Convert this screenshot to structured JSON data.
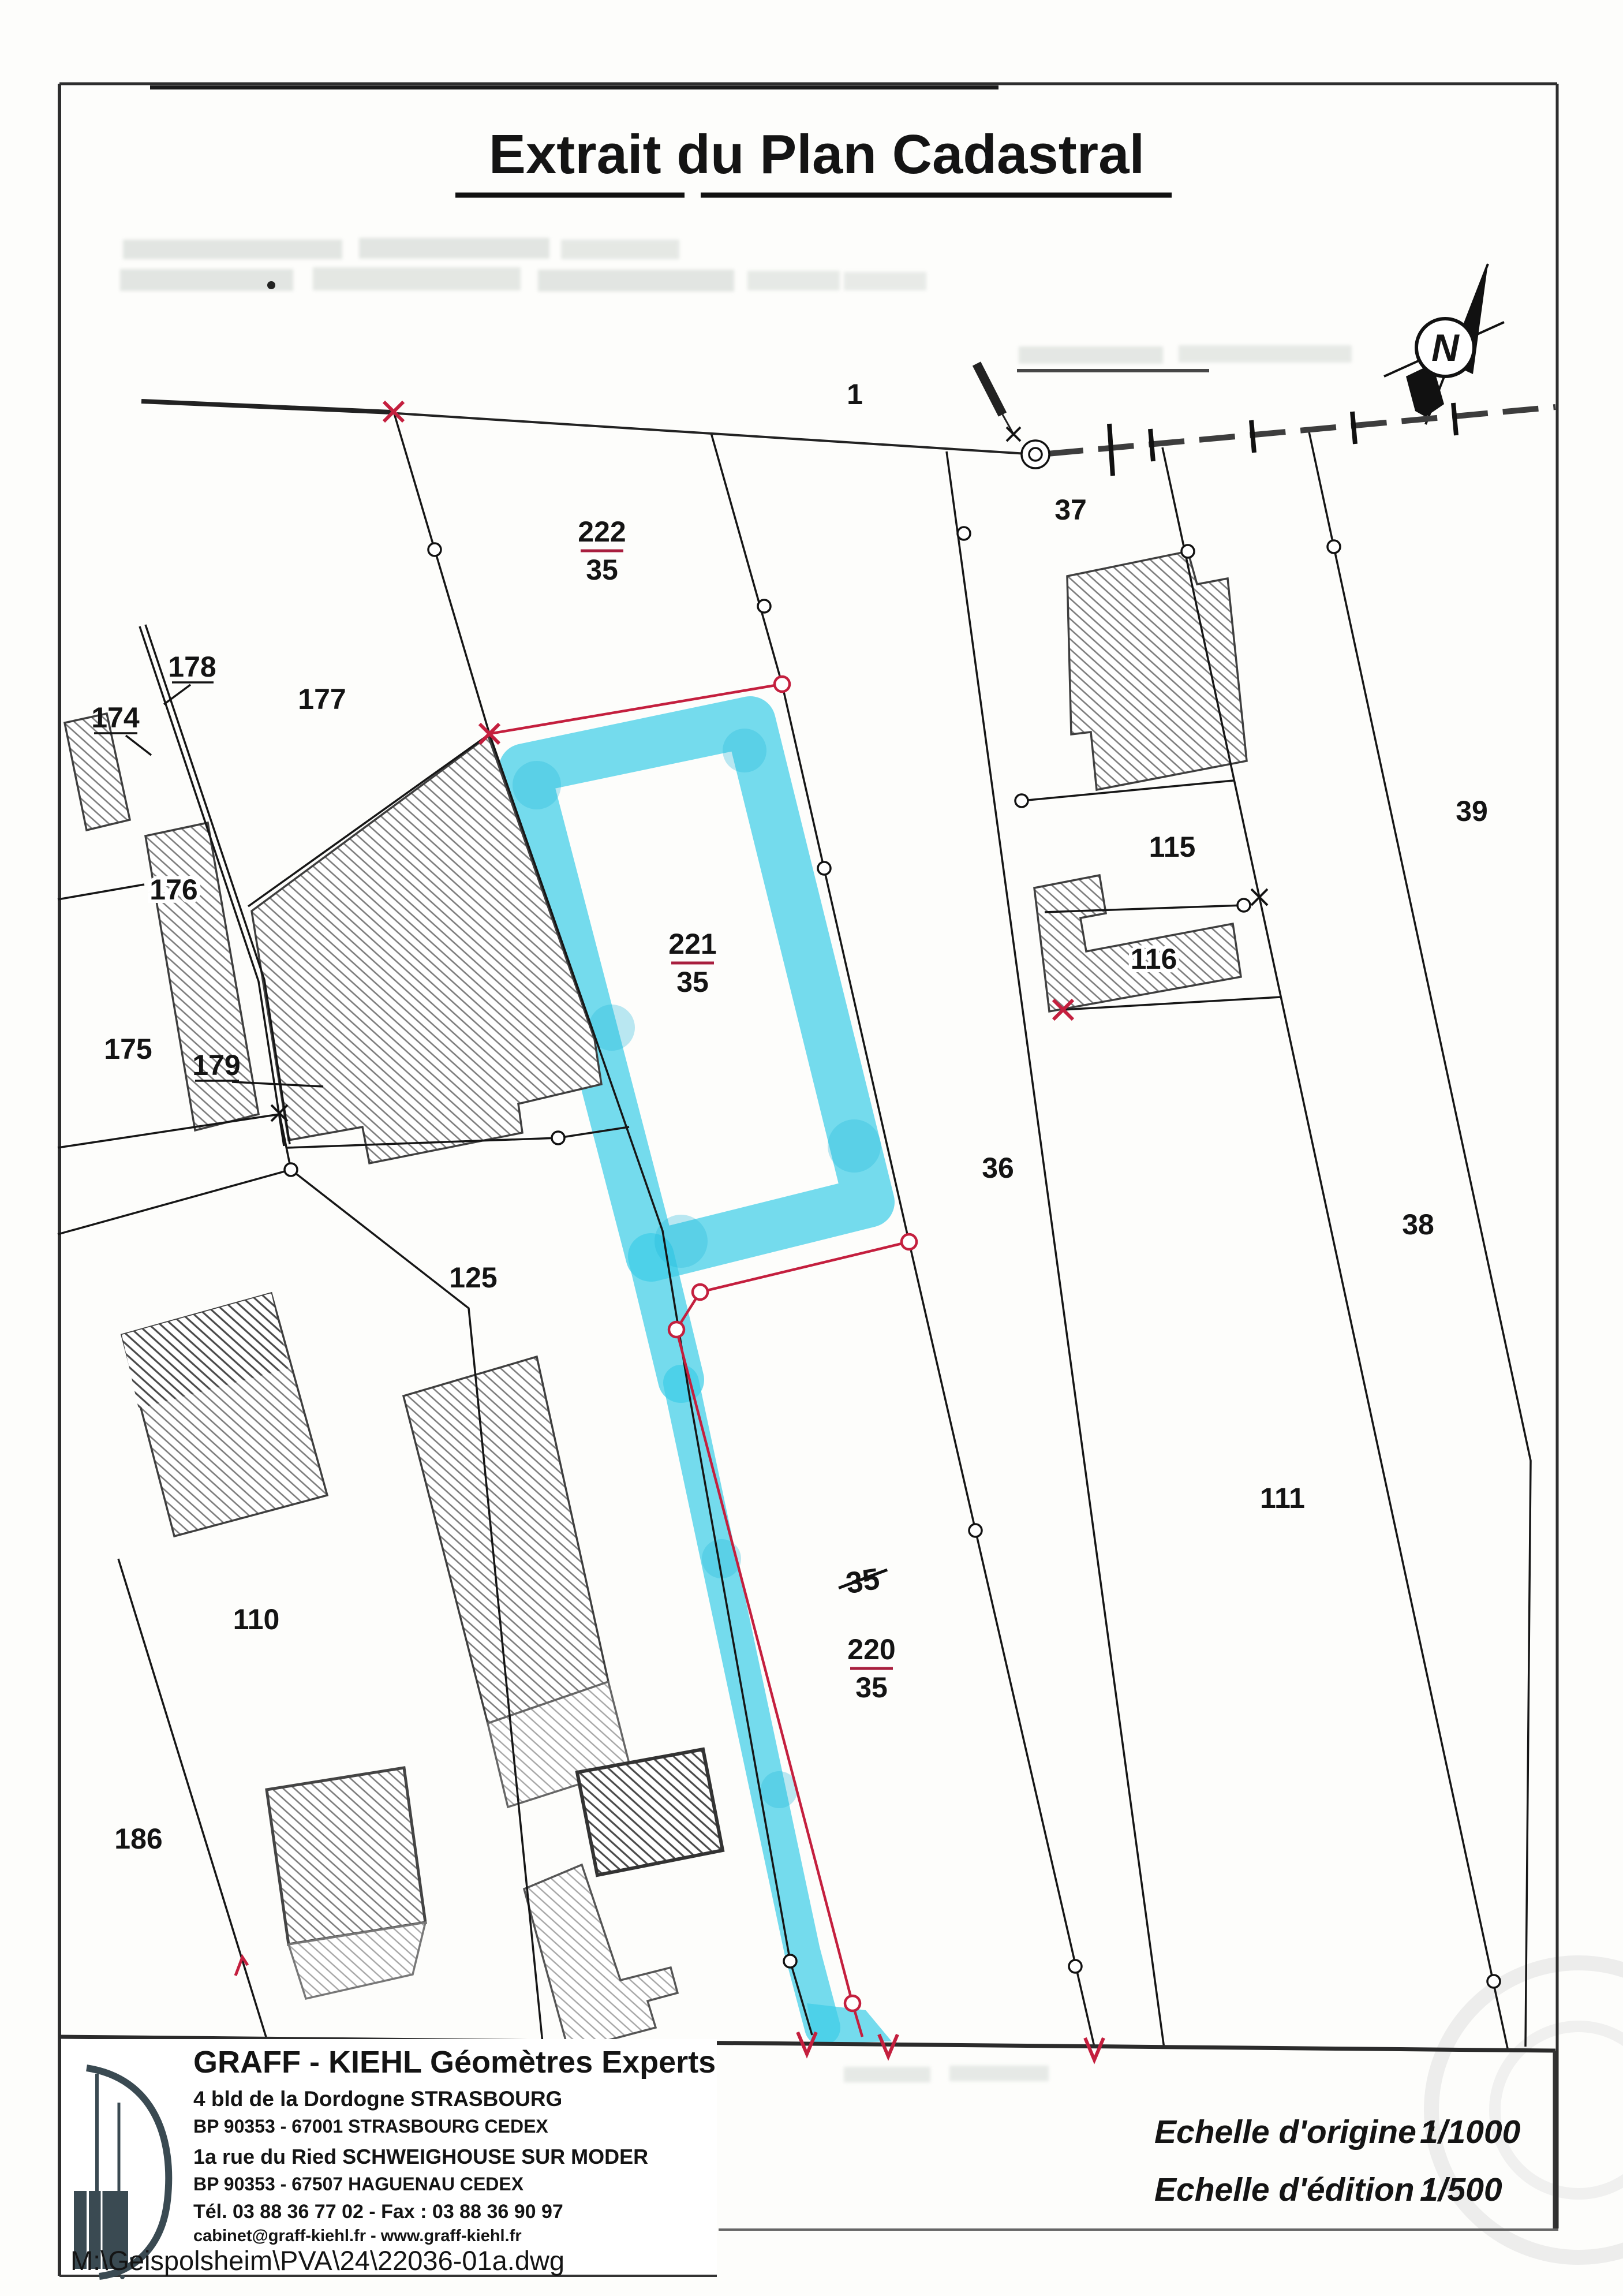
{
  "title": "Extrait du Plan Cadastral",
  "map": {
    "north_letter": "N",
    "parcel_labels": {
      "p1": "1",
      "p37": "37",
      "p177": "177",
      "p178": "178",
      "p174": "174",
      "p176": "176",
      "p175": "175",
      "p179": "179",
      "p125": "125",
      "p110": "110",
      "p186": "186",
      "p115": "115",
      "p116": "116",
      "p36": "36",
      "p38": "38",
      "p39": "39",
      "p111": "111"
    },
    "struck_label": "35",
    "fraction_labels": [
      {
        "num": "222",
        "den": "35"
      },
      {
        "num": "221",
        "den": "35"
      },
      {
        "num": "220",
        "den": "35"
      }
    ],
    "highlight_color": "#3fcde8",
    "boundary_red": "#c41f3e"
  },
  "footer": {
    "firm": "GRAFF - KIEHL Géomètres Experts",
    "address_lines": [
      "4 bld de la Dordogne STRASBOURG",
      "BP 90353 - 67001 STRASBOURG CEDEX",
      "1a rue du Ried SCHWEIGHOUSE SUR MODER",
      "BP 90353 - 67507 HAGUENAU CEDEX"
    ],
    "tel_fax": "Tél. 03 88 36 77 02 - Fax : 03 88 36 90 97",
    "web": "cabinet@graff-kiehl.fr - www.graff-kiehl.fr",
    "file_path": "M:\\Geispolsheim\\PVA\\24\\22036-01a.dwg"
  },
  "scales": {
    "origin_label": "Echelle d'origine :",
    "origin_value": "1/1000",
    "edition_label": "Echelle d'édition :",
    "edition_value": "1/500"
  }
}
